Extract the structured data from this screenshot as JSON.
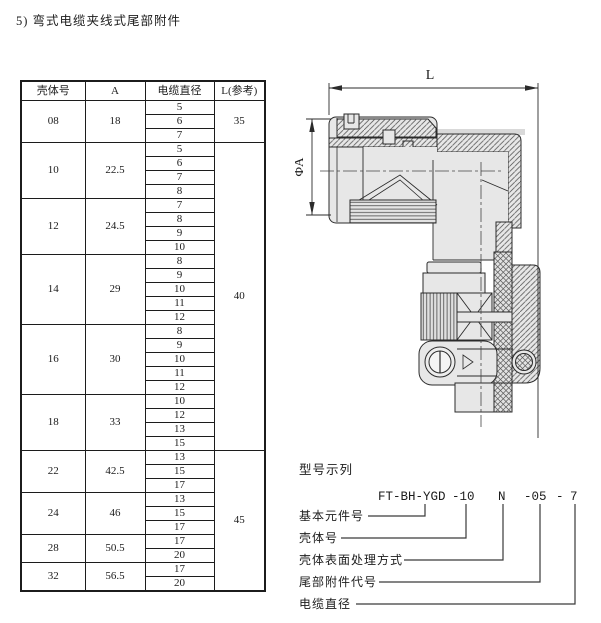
{
  "title": "5) 弯式电缆夹线式尾部附件",
  "table": {
    "headers": [
      "壳体号",
      "A",
      "电缆直径",
      "L(参考)"
    ],
    "groups": [
      {
        "shell": "08",
        "a": "18",
        "diameters": [
          "5",
          "6",
          "7"
        ]
      },
      {
        "shell": "10",
        "a": "22.5",
        "diameters": [
          "5",
          "6",
          "7",
          "8"
        ]
      },
      {
        "shell": "12",
        "a": "24.5",
        "diameters": [
          "7",
          "8",
          "9",
          "10"
        ]
      },
      {
        "shell": "14",
        "a": "29",
        "diameters": [
          "8",
          "9",
          "10",
          "11",
          "12"
        ]
      },
      {
        "shell": "16",
        "a": "30",
        "diameters": [
          "8",
          "9",
          "10",
          "11",
          "12"
        ]
      },
      {
        "shell": "18",
        "a": "33",
        "diameters": [
          "10",
          "12",
          "13",
          "15"
        ]
      },
      {
        "shell": "22",
        "a": "42.5",
        "diameters": [
          "13",
          "15",
          "17"
        ]
      },
      {
        "shell": "24",
        "a": "46",
        "diameters": [
          "13",
          "15",
          "17"
        ]
      },
      {
        "shell": "28",
        "a": "50.5",
        "diameters": [
          "17",
          "20"
        ]
      },
      {
        "shell": "32",
        "a": "56.5",
        "diameters": [
          "17",
          "20"
        ]
      }
    ],
    "l_spans": [
      {
        "value": "35",
        "start_group": 0,
        "group_count": 1
      },
      {
        "value": "40",
        "start_group": 1,
        "group_count": 5
      },
      {
        "value": "45",
        "start_group": 6,
        "group_count": 4
      }
    ]
  },
  "drawing": {
    "dim_length_label": "L",
    "dim_diameter_label": "ΦA"
  },
  "model_example": {
    "heading": "型号示列",
    "code_parts": {
      "base": "FT-BH-YGD",
      "shell": "-10",
      "finish": "N",
      "tail": "-05",
      "sep": "-",
      "cable": "7"
    },
    "labels": [
      "基本元件号",
      "壳体号",
      "壳体表面处理方式",
      "尾部附件代号",
      "电缆直径"
    ]
  },
  "colors": {
    "metal_fill": "#e7e7e7",
    "line": "#2b2b2b"
  }
}
